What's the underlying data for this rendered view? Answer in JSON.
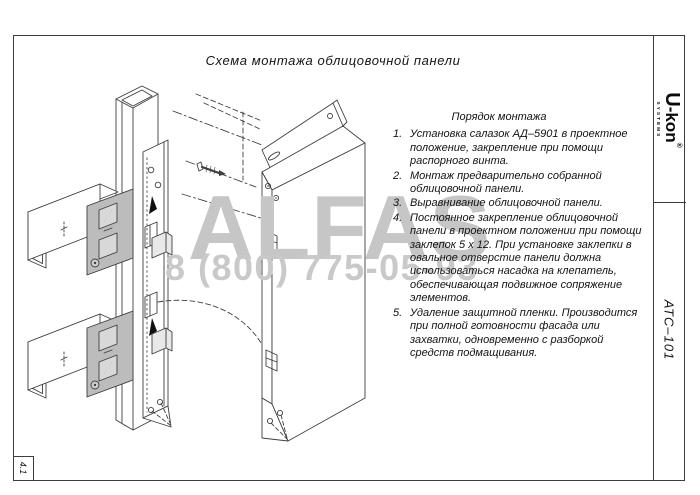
{
  "page": {
    "title": "Схема монтажа облицовочной панели",
    "sheet_code": "АТС–101",
    "sheet_number": "4.1"
  },
  "logo": {
    "brand_u": "U",
    "brand_rest": "-kon",
    "reg": "®",
    "sub": "SYSTEMS"
  },
  "instructions": {
    "heading": "Порядок монтажа",
    "items": [
      {
        "num": "1.",
        "text": "Установка салазок АД–5901 в проектное положение, закрепление при помощи распорного винта."
      },
      {
        "num": "2.",
        "text": "Монтаж предварительно собранной облицовочной панели."
      },
      {
        "num": "3.",
        "text": "Выравнивание облицовочной панели."
      },
      {
        "num": "4.",
        "text": "Постоянное закрепление облицовочной панели в проектном положении при помощи заклепок 5 х 12. При установке заклепки в овальное отверстие панели должна использоваться насадка на клепатель, обеспечивающая подвижное сопряжение элементов."
      },
      {
        "num": "5.",
        "text": "Удаление защитной пленки. Производится при полной готовности фасада или захватки, одновременно с разборкой средств подмащивания."
      }
    ]
  },
  "watermark": {
    "word": "ALFAS",
    "phone": "8 (800) 775-05-93"
  },
  "colors": {
    "line": "#3f3f3f",
    "plate_fill": "#bcbcbc",
    "watermark": "#c6c6c6",
    "frame": "#3c3c3c"
  }
}
